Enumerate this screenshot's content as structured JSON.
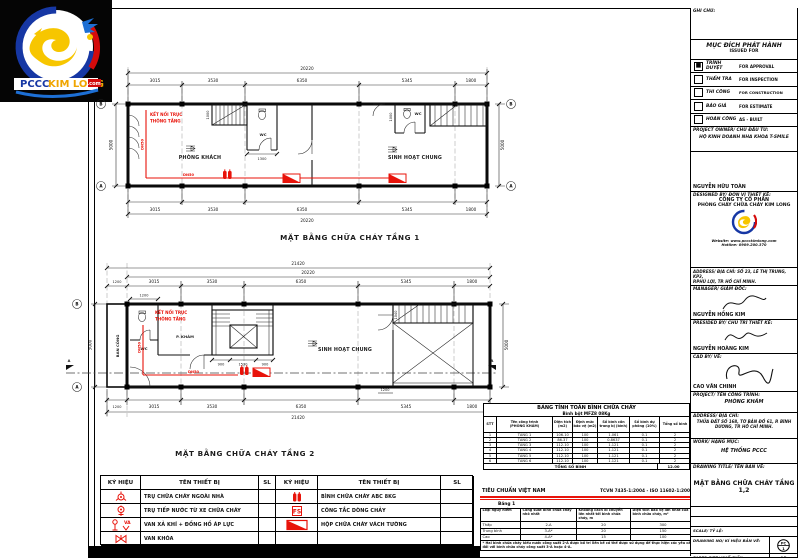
{
  "logo": {
    "pccc": "PCCC",
    "kimlong": "KIM LONG",
    "dotcom": ".com"
  },
  "plan1": {
    "title": "MẶT BẰNG CHỮA CHÁY TẦNG 1",
    "overall_dim": "20220",
    "dims_top": [
      "3015",
      "3530",
      "6350",
      "5345",
      "1800"
    ],
    "dims_bottom": [
      "3015",
      "3530",
      "6350",
      "5345",
      "1800"
    ],
    "dim_left": "5000",
    "dim_right": "5000",
    "dim_wc": "1300",
    "dim_stair": "1000",
    "dim_stair2": "1000",
    "rooms": {
      "living": "PHÒNG KHÁCH",
      "common": "SINH HOẠT CHUNG",
      "wc1": "WC",
      "wc2": "WC"
    },
    "shaft_note_1": "KẾT NỐI TRỤC",
    "shaft_note_2": "THÔNG TẦNG",
    "pipe_label": "DN50",
    "grid_top": "B",
    "grid_bottom": "A"
  },
  "plan2": {
    "title": "MẶT BẰNG CHỮA CHÁY TẦNG 2",
    "overall_dim_outer": "21420",
    "overall_dim": "20220",
    "dims_top": [
      "1200",
      "3015",
      "3530",
      "6350",
      "5345",
      "1800"
    ],
    "dims_bottom": [
      "1200",
      "3015",
      "3530",
      "6350",
      "5345",
      "1800"
    ],
    "dim_left": "5000",
    "dim_right": "5000",
    "dims_stair": [
      "900",
      "1530",
      "900"
    ],
    "dim_top_small": "1200",
    "dim_corridor": "1200",
    "dim_void": "1040",
    "rooms": {
      "balcony": "BAN CÔNG",
      "wc": "WC",
      "exam": "P. KHÁM",
      "common": "SINH HOẠT CHUNG"
    },
    "shaft_note_1": "KẾT NỐI TRỤC",
    "shaft_note_2": "THÔNG TẦNG",
    "pipe_label": "DN50",
    "grid_top": "B",
    "grid_bottom": "A",
    "section_label": "A"
  },
  "legend": {
    "col_symbol": "KÝ HIỆU",
    "col_name": "TÊN THIẾT BỊ",
    "col_qty": "SL",
    "left_rows": [
      "TRỤ CHỮA CHÁY NGOÀI NHÀ",
      "TRỤ TIẾP NƯỚC TỪ XE CHỮA CHÁY",
      "VAN XẢ KHÍ + ĐỒNG HỒ ÁP LỰC",
      "VAN KHÓA"
    ],
    "right_rows": [
      "BÌNH CHỮA CHÁY ABC 8KG",
      "CÔNG TẮC DÒNG CHẢY",
      "HỘP CHỮA CHÁY VÁCH TƯỜNG",
      ""
    ]
  },
  "calc_table": {
    "title": "BẢNG TÍNH TOÁN BÌNH CHỮA CHÁY",
    "subtitle": "Bình bột MFZ8 08Kg",
    "headers": [
      "STT",
      "Tên công trình\n(PHÒNG KHÁM)",
      "Diện tích (m2)",
      "Định mức bảo vệ (m2)",
      "Số bình cần trang bị (bình)",
      "Số bình dự phòng (10%)",
      "Tổng số bình"
    ],
    "rows": [
      [
        "1",
        "TẦNG 1",
        "106.10",
        "100",
        "1.061",
        "0.1",
        "2"
      ],
      [
        "2",
        "TẦNG 2",
        "86.37",
        "100",
        "0.8637",
        "0.1",
        "2"
      ],
      [
        "3",
        "TẦNG 3",
        "112.10",
        "100",
        "1.121",
        "0.1",
        "2"
      ],
      [
        "4",
        "TẦNG 4",
        "112.10",
        "100",
        "1.121",
        "0.1",
        "2"
      ],
      [
        "5",
        "TẦNG 5",
        "112.10",
        "100",
        "1.121",
        "0.1",
        "2"
      ],
      [
        "6",
        "TẦNG 6",
        "112.10",
        "100",
        "1.121",
        "0.1",
        "2"
      ]
    ],
    "total_label": "TỔNG SỐ BÌNH",
    "total_value": "12.00"
  },
  "standard": {
    "left": "TIÊU CHUẨN VIỆT NAM",
    "right": "TCVN 7435-1:2004 - ISO 11602-1:2000",
    "table_label": "Bảng 1",
    "headers": [
      "Loại nguy hiểm",
      "Công suất bình chữa cháy nhỏ nhất",
      "Khoảng cách di chuyển lớn nhất tới bình chữa cháy, m",
      "Diện tích bảo vệ lớn nhất của 1 bình chữa cháy, m²"
    ],
    "rows": [
      [
        "Thấp",
        "2-A",
        "20",
        "300"
      ],
      [
        "Trung bình",
        "3-A*",
        "20",
        "150"
      ],
      [
        "Cao",
        "4-A*",
        "15",
        "100"
      ]
    ],
    "footnote": "* Hai bình chữa cháy kiểu nước công suất 2-A được bố trí liền kề có thể được sử dụng để thực hiện các yêu cầu đối với bình chữa cháy công suất 3-A hoặc 4-A."
  },
  "titleblock": {
    "notes_label": "GHI CHÚ:",
    "purpose_vn": "MỤC ĐÍCH PHÁT HÀNH",
    "purpose_en": "ISSUED FOR",
    "checks": [
      {
        "vn": "TRÌNH DUYỆT",
        "en": "FOR APPROVAL",
        "mark": "■"
      },
      {
        "vn": "THẨM TRA",
        "en": "FOR INSPECTION",
        "mark": ""
      },
      {
        "vn": "THI CÔNG",
        "en": "FOR CONSTRUCTION",
        "mark": ""
      },
      {
        "vn": "BÁO GIÁ",
        "en": "FOR ESTIMATE",
        "mark": ""
      },
      {
        "vn": "HOÀN CÔNG",
        "en": "AS - BUILT",
        "mark": ""
      }
    ],
    "owner_label": "PROJECT OWNER/ CHỦ ĐẦU TƯ:",
    "owner_name": "HỘ KINH DOANH NHA KHOA T-SMILE",
    "owner_sign_name": "NGUYỄN HỮU TOÀN",
    "designer_label": "DESIGNED BY/ ĐƠN VỊ THIẾT KẾ:",
    "company_1": "CÔNG TY CỔ PHẦN",
    "company_2": "PHÒNG CHÁY CHỮA CHÁY KIM LONG",
    "website": "Website: www.pccckimlong.com",
    "hotline": "Hotline: 0909.200.370",
    "address1_label": "ADDRESS/ ĐỊA CHỈ:  SỐ 23, LÊ THỊ TRUNG, KP3,",
    "address1_line2": "P.PHÚ LỢI, TP. HỒ CHÍ MINH.",
    "manager_label": "MANAGER/ GIÁM ĐỐC:",
    "manager_name": "NGUYỄN HỒNG KIM",
    "presided_label": "PRESIDED BY/ CHỦ TRÌ THIẾT KẾ:",
    "presided_name": "NGUYỄN HOÀNG KIM",
    "cad_label": "CAD BY/ VẼ:",
    "cad_name": "CAO VĂN CHINH",
    "project_label": "PROJECT/ TÊN CÔNG TRÌNH:",
    "project_name": "PHÒNG KHÁM",
    "address2_label": "ADDRESS/ ĐỊA CHỈ:",
    "address2_value": "THỬA ĐẤT SỐ 168, TỜ BẢN ĐỒ 61, P. BÌNH DƯƠNG, TP. HỒ CHÍ MINH.",
    "work_label": "WORK/ HẠNG MỤC:",
    "work_value": "HỆ THỐNG PCCC",
    "drawing_title_label": "DRAWING TITLE/ TÊN BẢN VẼ:",
    "drawing_title": "MẶT BẰNG CHỮA CHÁY TẦNG 1,2",
    "issue_label": "ISSUE DATE/ NGÀY TẠO:",
    "issue_value": "18/03/25",
    "updated_label": "UPDATED DAY/ NGÀY CHỈNH SỬA:",
    "updated_value": "19/03/25",
    "scale_label": "SCALE/ TỶ LỆ:",
    "number_label": "DRAWING NO/ KÍ HIỆU BẢN VẼ:",
    "number_top": "PC",
    "number_bottom": "1",
    "paper_label": "PAPER SIZE/ KHỔ GIẤY:",
    "paper_value": "A3"
  }
}
